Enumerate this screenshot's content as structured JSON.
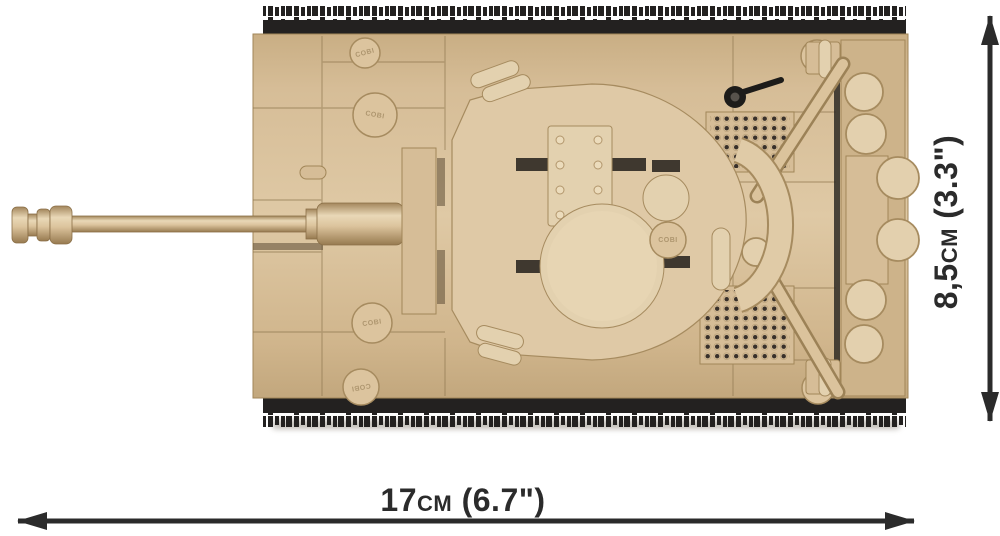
{
  "image": {
    "alt": "Top view of a tan brick-built tank model with black tracks and a long gun barrel pointing left, annotated with its physical dimensions"
  },
  "tank": {
    "stud_logo": "COBI"
  },
  "dimensions": {
    "width_label": "17cm (6.7\")",
    "height_label": "8,5cm (3.3\")"
  },
  "colors": {
    "bg": "#ffffff",
    "annot": "#2b2b2b",
    "tan": "#d6bd97",
    "tan-light": "#e9d9ba",
    "tan-mid": "#cdb38a",
    "tan-dark": "#b2966c",
    "tan-deep": "#8f774f",
    "black": "#232120",
    "grille-dot": "#38302a"
  }
}
